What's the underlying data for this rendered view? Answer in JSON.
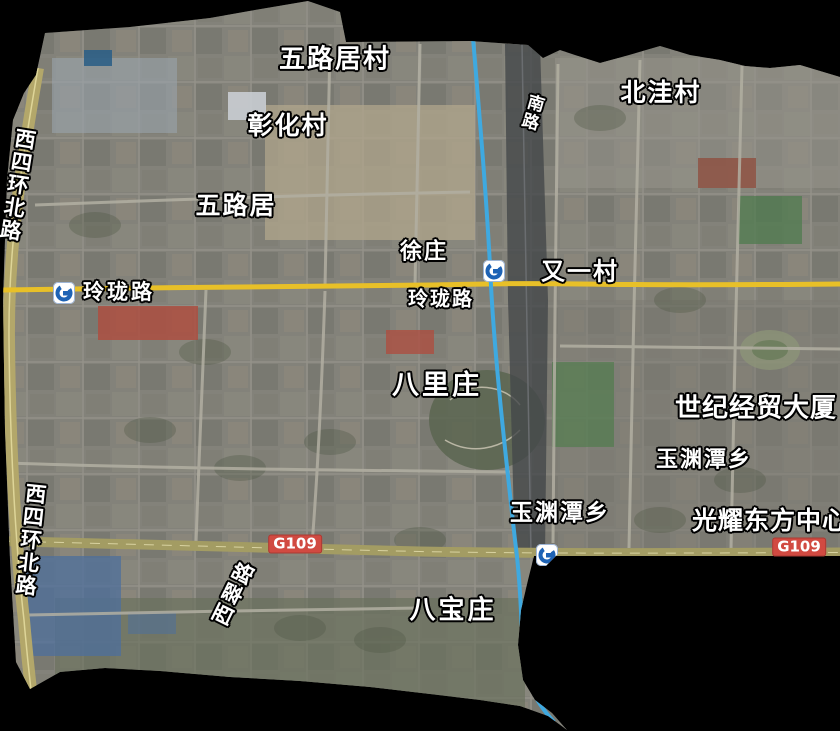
{
  "map": {
    "labels": {
      "wulujucun": "五路居村",
      "zhanghuacun": "彰化村",
      "beiwacun": "北洼村",
      "nanlu": "南路",
      "wuluju": "五路居",
      "xuzhuang": "徐庄",
      "youyicun": "又一村",
      "linglonglu_west": "玲珑路",
      "linglonglu_center": "玲珑路",
      "balizhuang": "八里庄",
      "shiji_jingmao_dasha": "世纪经贸大厦",
      "yuyuantanxiang_east": "玉渊潭乡",
      "yuyuantanxiang_south": "玉渊潭乡",
      "guangyao_dongfang_zhongxin": "光耀东方中心",
      "babaozhuang": "八宝庄",
      "xicuilu": "西翠路",
      "xisihuanbeilu_north": "西四环北路",
      "xisihuanbeilu_south": "西四环北路"
    },
    "badges": {
      "g109_west": "G109",
      "g109_east": "G109"
    },
    "icons": {
      "metro_station": "metro-station-icon"
    },
    "colors": {
      "road_linglong_yellow": "#e8c028",
      "road_g109_olive": "#a39c63",
      "road_ring_tan": "#b3a76a",
      "water_blue": "#3fa9e0",
      "badge_red": "#d14a41",
      "metro_blue": "#1e63b5",
      "outside_mask": "#000000"
    }
  }
}
